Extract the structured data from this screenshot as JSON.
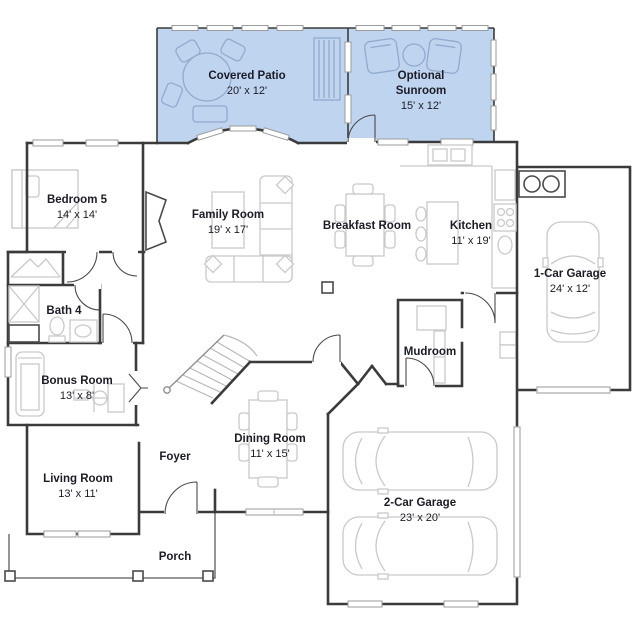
{
  "plan": {
    "title": "Single-family home first-floor plan",
    "colors": {
      "wall": "#3b3b3b",
      "furniture": "#c9c9c9",
      "highlight_fill": "#bfd4ef",
      "highlight_stroke": "#93a9ce",
      "label": "#1c1c28",
      "window_stroke": "#9b9b9b",
      "garage_door": "#b5b5b5"
    },
    "rooms": [
      {
        "id": "covered-patio",
        "name_lines": [
          "Covered Patio"
        ],
        "dims": "20' x 12'",
        "x": 247,
        "y": 79,
        "highlighted": true
      },
      {
        "id": "optional-sunroom",
        "name_lines": [
          "Optional",
          "Sunroom"
        ],
        "dims": "15' x 12'",
        "x": 421,
        "y": 79,
        "highlighted": true
      },
      {
        "id": "bedroom-5",
        "name_lines": [
          "Bedroom 5"
        ],
        "dims": "14' x 14'",
        "x": 77,
        "y": 203,
        "highlighted": false
      },
      {
        "id": "family-room",
        "name_lines": [
          "Family Room"
        ],
        "dims": "19' x 17'",
        "x": 228,
        "y": 218,
        "highlighted": false
      },
      {
        "id": "breakfast-room",
        "name_lines": [
          "Breakfast Room"
        ],
        "dims": null,
        "x": 367,
        "y": 229,
        "highlighted": false
      },
      {
        "id": "kitchen",
        "name_lines": [
          "Kitchen"
        ],
        "dims": "11' x 19'",
        "x": 471,
        "y": 229,
        "highlighted": false
      },
      {
        "id": "one-car-garage",
        "name_lines": [
          "1-Car Garage"
        ],
        "dims": "24' x 12'",
        "x": 570,
        "y": 277,
        "highlighted": false
      },
      {
        "id": "bath-4",
        "name_lines": [
          "Bath 4"
        ],
        "dims": null,
        "x": 64,
        "y": 314,
        "highlighted": false
      },
      {
        "id": "bonus-room",
        "name_lines": [
          "Bonus Room"
        ],
        "dims": "13' x 8'",
        "x": 77,
        "y": 384,
        "highlighted": false
      },
      {
        "id": "mudroom",
        "name_lines": [
          "Mudroom"
        ],
        "dims": null,
        "x": 430,
        "y": 355,
        "highlighted": false
      },
      {
        "id": "living-room",
        "name_lines": [
          "Living Room"
        ],
        "dims": "13' x 11'",
        "x": 78,
        "y": 482,
        "highlighted": false
      },
      {
        "id": "foyer",
        "name_lines": [
          "Foyer"
        ],
        "dims": null,
        "x": 175,
        "y": 460,
        "highlighted": false
      },
      {
        "id": "dining-room",
        "name_lines": [
          "Dining Room"
        ],
        "dims": "11' x 15'",
        "x": 270,
        "y": 442,
        "highlighted": false
      },
      {
        "id": "two-car-garage",
        "name_lines": [
          "2-Car Garage"
        ],
        "dims": "23' x 20'",
        "x": 420,
        "y": 506,
        "highlighted": false
      },
      {
        "id": "porch",
        "name_lines": [
          "Porch"
        ],
        "dims": null,
        "x": 175,
        "y": 560,
        "highlighted": false
      }
    ],
    "line_spacing": 15
  }
}
